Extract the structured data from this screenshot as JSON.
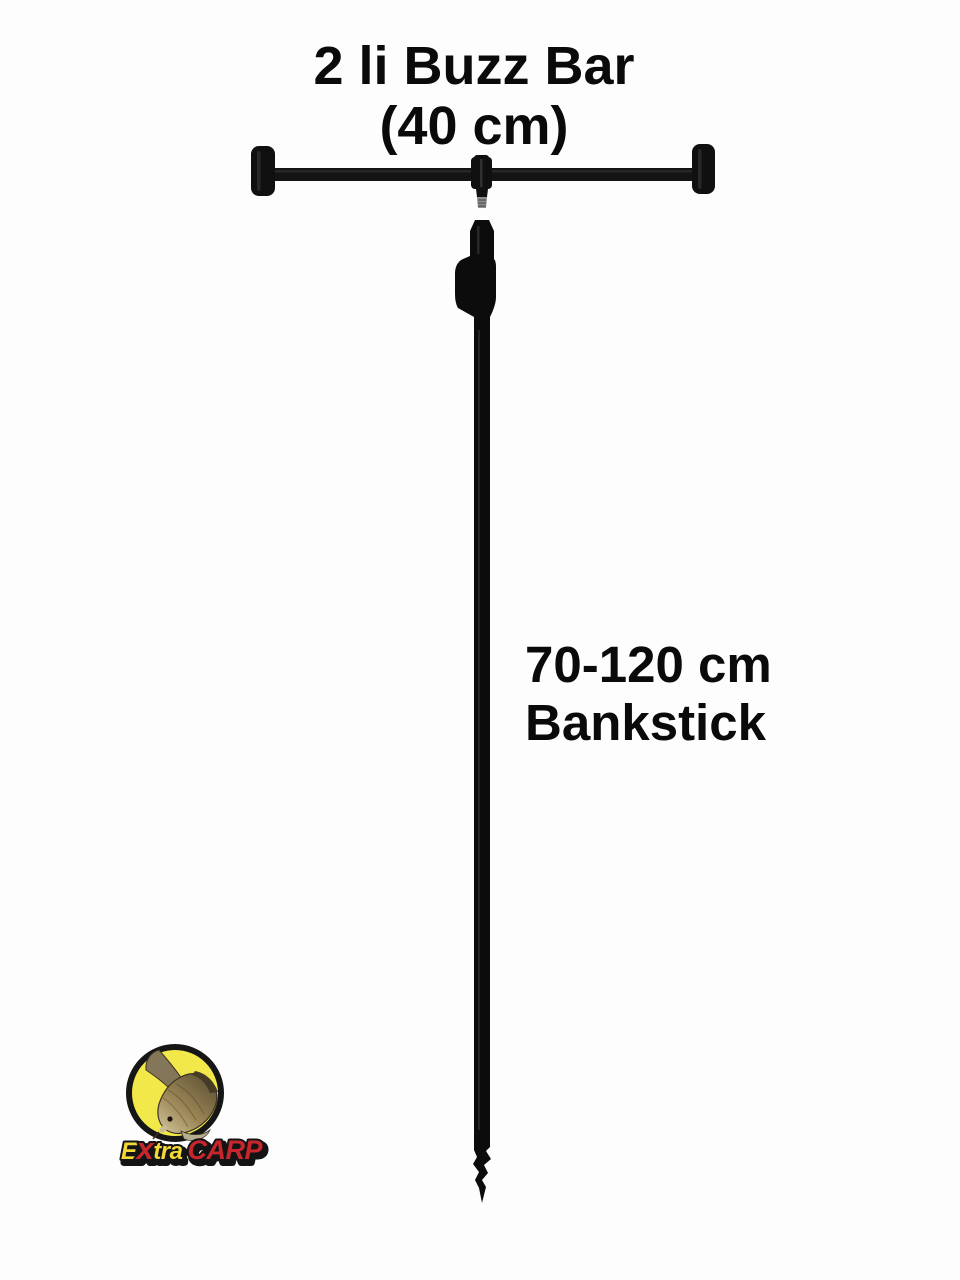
{
  "background": "#fdfdfd",
  "title": {
    "line1": "2 li Buzz Bar",
    "line2": "(40 cm)"
  },
  "bankstick_label": {
    "line1": "70-120 cm",
    "line2": "Bankstick"
  },
  "logo": {
    "text": {
      "e": "E",
      "x": "x",
      "tra": "tra",
      "carp": "CARP"
    },
    "colors": {
      "circle_fill": "#f3e84a",
      "circle_border": "#161616",
      "yellow_text": "#f2d838",
      "red_text": "#c8262d",
      "outline": "#141414"
    }
  },
  "product_colors": {
    "buzzbar": "#101010",
    "bar_rod": "#141414",
    "bankstick": "#0c0c0c",
    "thread_stud": "#8e8e8e"
  },
  "text_color": "#0a0a0a"
}
